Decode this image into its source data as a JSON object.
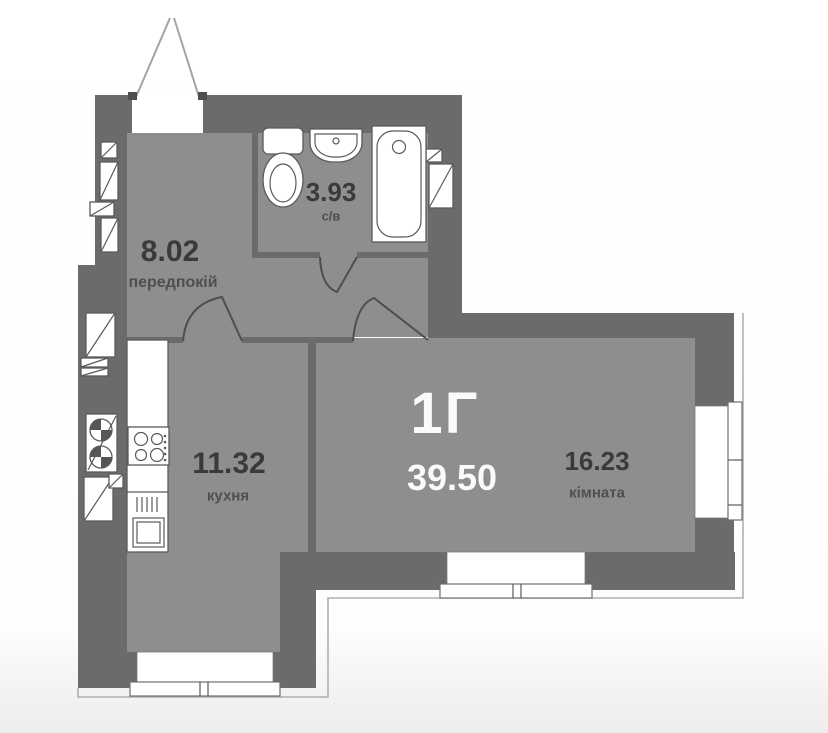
{
  "plan": {
    "unit_label": "1Г",
    "total_area": "39.50",
    "rooms": [
      {
        "id": "hallway",
        "area": "8.02",
        "name": "передпокій"
      },
      {
        "id": "bathroom",
        "area": "3.93",
        "name": "с/в"
      },
      {
        "id": "kitchen",
        "area": "11.32",
        "name": "кухня"
      },
      {
        "id": "living_room",
        "area": "16.23",
        "name": "кімната"
      }
    ]
  },
  "colors": {
    "wall": "#6b6b6b",
    "floor": "#8e8e8e",
    "outline": "#4e4e4e",
    "fixture_stroke": "#5a5a5a",
    "exterior_line": "#b0b0b0",
    "area_text": "#3a3a3a",
    "name_text": "#4f4f4f",
    "unit_text": "#fafafa"
  }
}
